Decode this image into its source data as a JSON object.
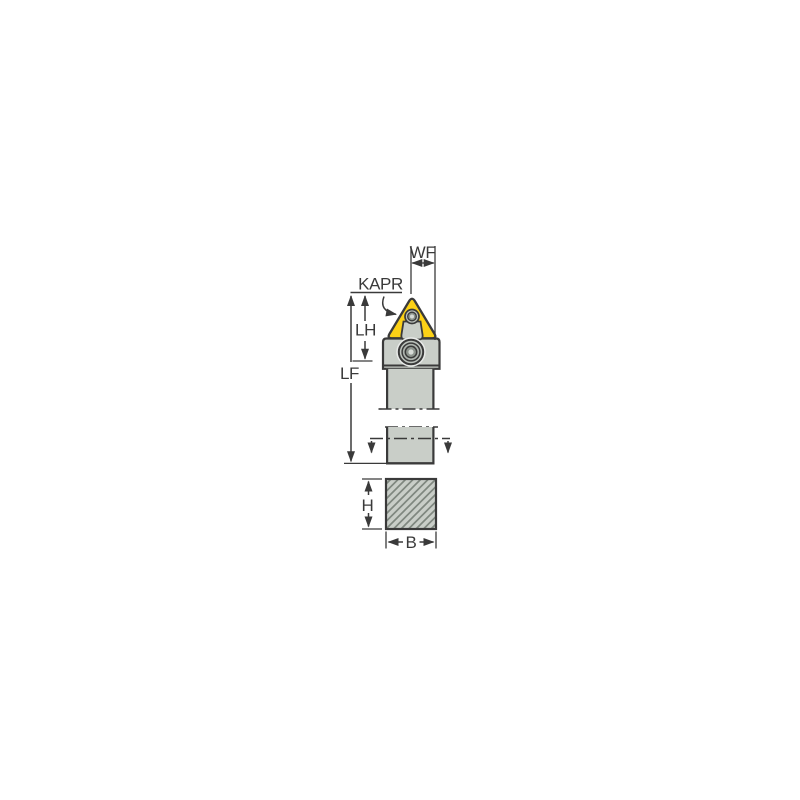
{
  "page": {
    "background": "#ffffff",
    "description": "Technical dimensional drawing of a lathe turning tool holder with triangular insert, shown in side view with a hatched square shank cross-section below"
  },
  "colors": {
    "background": "#ffffff",
    "line": "#3a3a3a",
    "insert_yellow": "#fcd116",
    "body_gray": "#c9cec8",
    "screw_outer": "#bcc2bc",
    "screw_mid": "#adb3ad",
    "screw_dark": "#8d948d",
    "screw_light": "#d7dbd7",
    "hatch_gray": "#7f877f",
    "counterbore": "#e9ebe9"
  },
  "diagram": {
    "labels": {
      "wf": "WF",
      "kapr": "KAPR",
      "lh": "LH",
      "lf": "LF",
      "h": "H",
      "b": "B"
    }
  }
}
